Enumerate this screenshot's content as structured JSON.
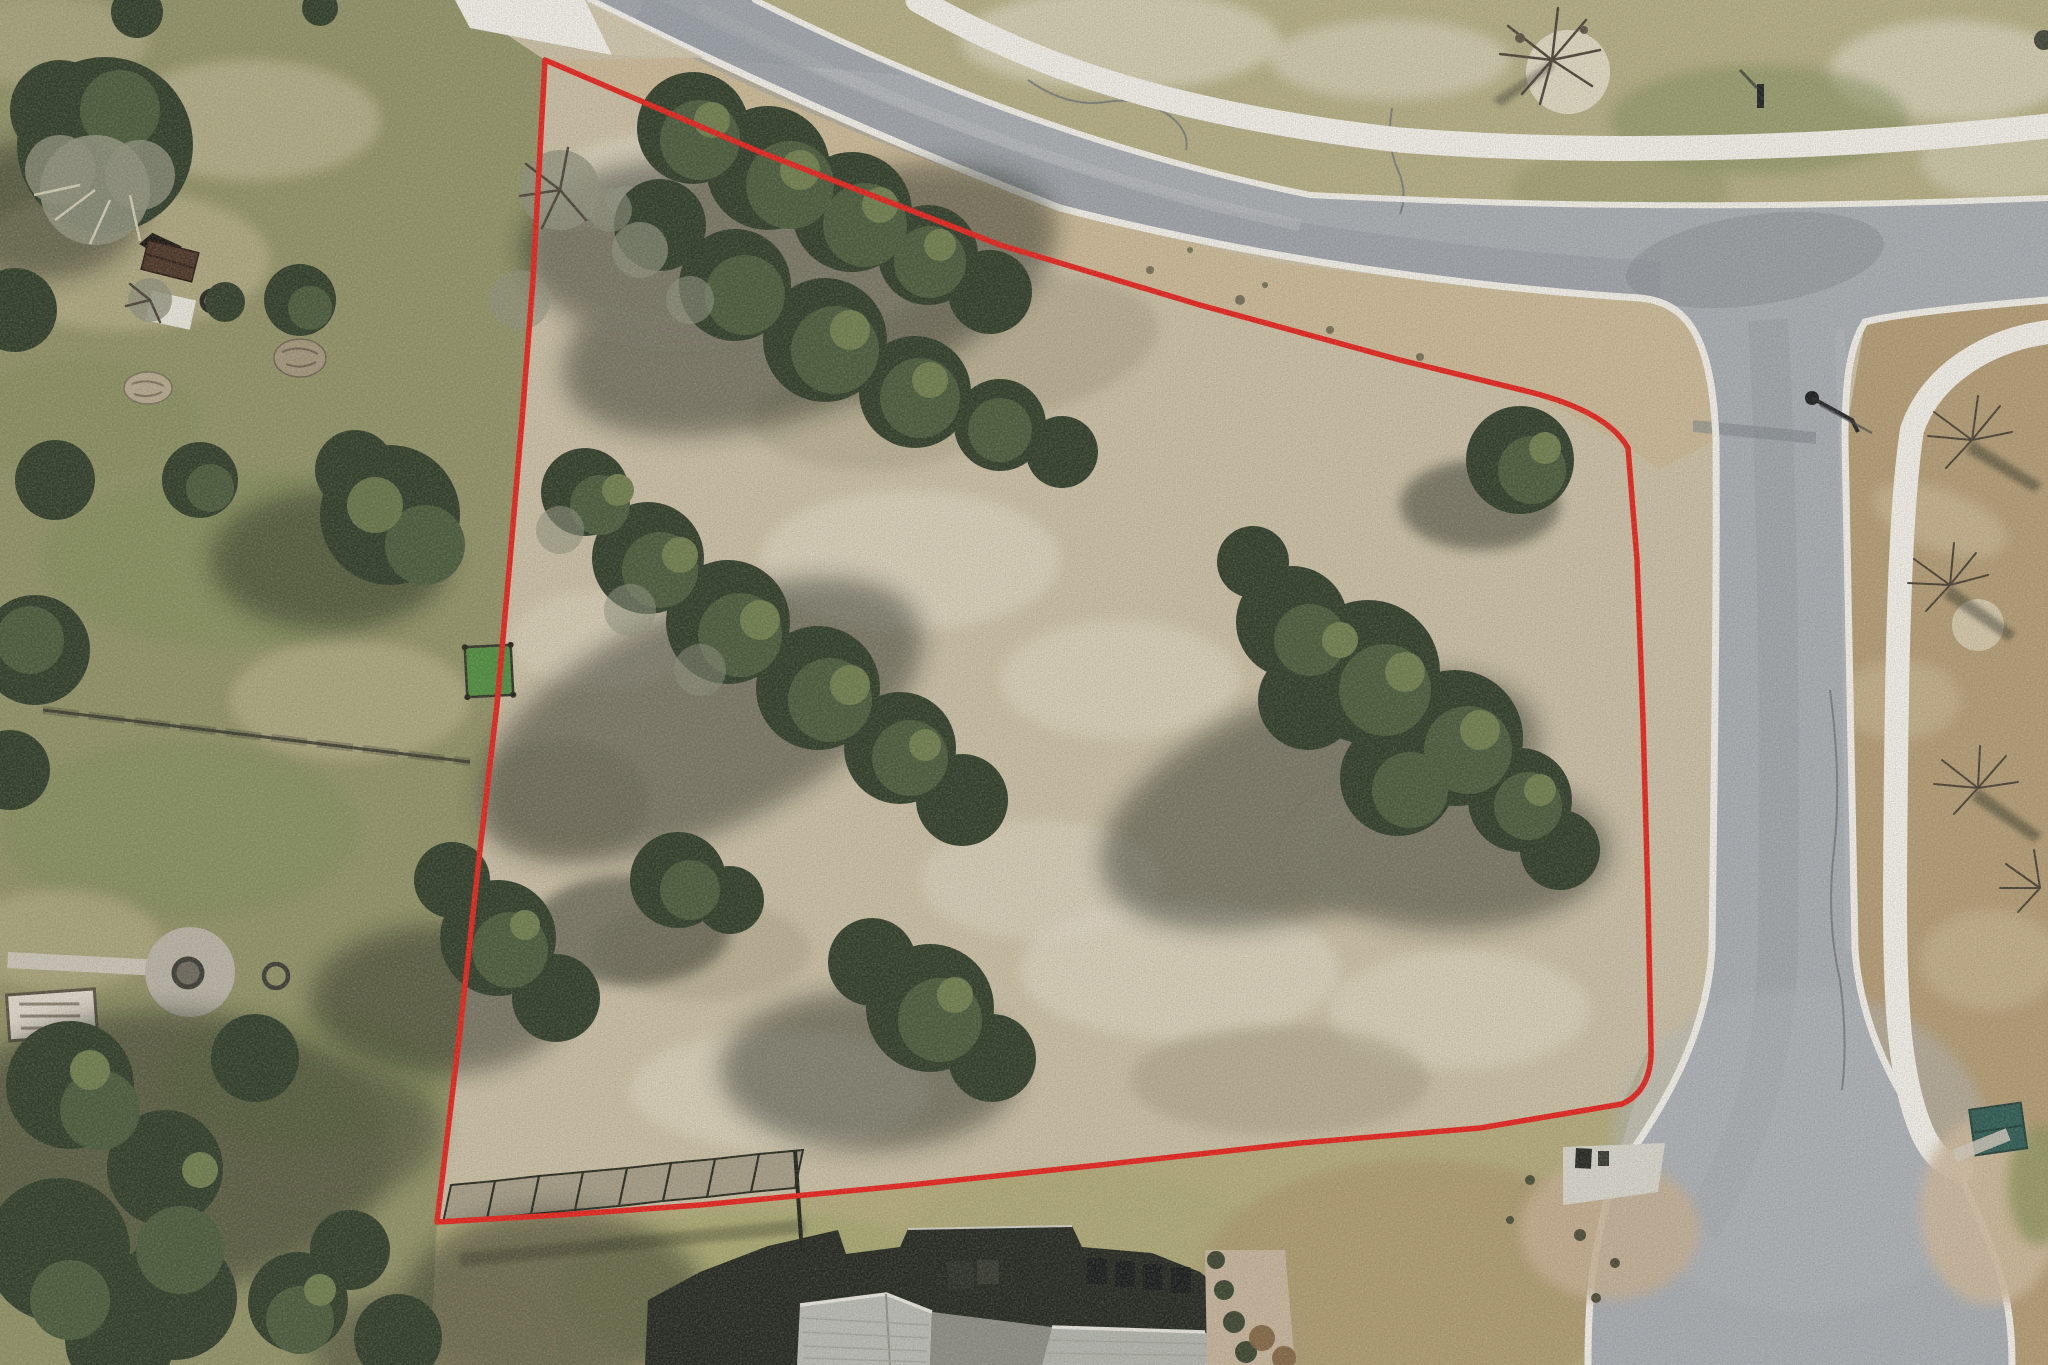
{
  "meta": {
    "type": "aerial-drone-photo",
    "description": "Overhead drone photo of a vacant wooded residential lot outlined with a red property-boundary line. A curved asphalt street with white concrete sidewalks runs along the top, a second street with a cul-de-sac bulb runs down the right side, a neighboring fenced yard with shed, fire pit and trees lies to the left, and the gray shingled roof of a house sits at bottom center. No text, UI chrome or labels are visible."
  },
  "colors": {
    "red": "#e3201a",
    "roadFill": "#a6abb1",
    "roadDark": "#8e949a",
    "roadLight": "#b7bcc0",
    "curb": "#efede6",
    "path": "#f0eee7",
    "lotGround": "#c8bda3",
    "lotPale": "#ddd6c2",
    "lotOlive": "#a29a7c",
    "gravelStrip": "#c9b795",
    "neighborGrass": "#8f9065",
    "neGrass": "#b2ab82",
    "nePale": "#d6cfb8",
    "eastField": "#b19a73",
    "bottomGrass": "#b2a97a",
    "treeDark": "#2e3c28",
    "treeMid": "#48593a",
    "treeLight": "#6d7c4c",
    "shadow": "#161d14",
    "houseShadow": "#22261f",
    "roofLight": "#b8b9b4",
    "roofMid": "#96978f",
    "shedBrown": "#4a3226",
    "tealShed": "#2c5a52",
    "turfGreen": "#4d8c3d",
    "fence": "#33342a"
  },
  "boundary": {
    "stroke_width": 5.5,
    "path": "M545,60 L760,152 L1000,245 L1200,305 L1400,360 L1530,392 Q1608,412 1628,448 L1637,560 L1643,720 L1648,900 L1651,1045 Q1653,1090 1622,1104 L1480,1128 L1300,1143 L1100,1165 L900,1186 L700,1205 L560,1215 L437,1222 L460,1030 L480,850 L497,705 L510,560 L522,420 L533,280 Z"
  },
  "regions": {
    "neighbor_west": "0,0 455,0 545,60 533,280 522,420 510,560 497,705 480,850 460,1030 437,1222 430,1365 0,1365",
    "south_strip": "437,1222 560,1215 700,1205 900,1186 1100,1165 1300,1143 1480,1128 1622,1104 1651,1045 1591,1250 1588,1365 430,1365",
    "northeast": "755,0 2048,0 2048,198 1800,212 1555,205 1310,195 1090,150 905,75",
    "east_field": "1865,322 2048,300 2048,1365 2012,1365 2000,1260 1962,1180 1905,1110 1862,1040 1855,950 1848,650 1845,440",
    "road_shoulder_wedge": "545,60 705,58 870,135 1060,208 1270,262 1480,288 1640,298 1690,303 1712,370 1716,440 1660,470 1628,448 1530,392 1400,360 1200,305 1000,245 760,152"
  },
  "roads": {
    "main_d": "M590,0 L755,0 C905,75 1090,150 1310,195 C1480,203 1700,212 2048,198 L2048,300 C1950,308 1890,315 1865,322 C1850,345 1845,380 1845,440 C1848,650 1852,850 1855,950 C1862,1040 1905,1110 1962,1180 C2000,1260 2012,1300 2012,1365 L1588,1365 C1588,1300 1591,1260 1612,1180 C1662,1110 1706,1040 1712,950 C1714,780 1717,600 1716,440 C1712,340 1690,303 1640,298 C1480,288 1270,262 1060,208 C870,135 705,58 590,0 Z",
    "curb_north_d": "M755,0 C905,75 1090,150 1310,195 C1480,203 1700,212 2048,198",
    "curb_southwest_d": "M590,0 C705,58 870,135 1060,208 C1270,262 1480,288 1640,298 C1690,303 1712,340 1716,440 C1717,600 1714,780 1712,950 C1706,1040 1662,1110 1612,1180 C1591,1260 1588,1300 1588,1365",
    "curb_east_d": "M2048,300 C1950,308 1890,315 1865,322 C1850,345 1845,380 1845,440 C1848,650 1852,850 1855,950 C1862,1040 1905,1110 1962,1180 C2000,1260 2012,1300 2012,1365",
    "streak_dark_top_d": "M640,10 C800,95 1000,180 1240,232 C1420,262 1560,275 1660,280",
    "streak_light_top_d": "M700,8 C860,90 1060,175 1300,225",
    "streak_dark_vert_d": "M1768,320 C1778,500 1780,700 1778,950 C1775,1060 1750,1140 1700,1230",
    "streak_light_vert_d": "M1840,330 C1846,500 1848,700 1850,950",
    "crack1_d": "M1028,80 q40,28 78,22 q36,-6 64,14 q20,16 16,34",
    "crack2_d": "M1392,108 q-6,36 6,62 q10,24 2,44",
    "crack3_d": "M1830,690 q12,90 4,160 q-8,70 6,130 q8,60 2,110"
  },
  "walkways": {
    "northwest_points": "455,0 585,0 612,55 470,28",
    "shoulder_wedge_points": "585,0 705,58 612,55",
    "north_d": "M918,0 C1040,70 1180,115 1400,140 C1600,156 1850,148 2048,126",
    "southeast_d": "M2048,332 C1990,340 1932,372 1912,430 C1898,520 1896,700 1895,900 C1895,1010 1900,1080 1922,1132 C1934,1158 1948,1166 1962,1170"
  },
  "fences": {
    "cross_points": "43,710 470,762",
    "west_points": "497,705 480,850 460,1030 438,1215",
    "south_shadow_points": "460,1260 805,1226"
  },
  "house": {
    "shadow_d": "M645,1365 L648,1300 L700,1272 L768,1246 L838,1230 L846,1254 L900,1247 L908,1229 L1072,1226 L1082,1247 L1152,1253 L1200,1272 L1237,1303 L1243,1365 Z",
    "roof_left_d": "M797,1365 L800,1305 L886,1294 L932,1312 L930,1365 Z",
    "roof_mid_d": "M930,1365 L932,1312 L1052,1327 L1042,1365 Z",
    "roof_right_d": "M1042,1365 L1052,1327 L1205,1332 L1237,1365 Z",
    "patio_d": "M1205,1250 L1285,1250 L1295,1365 L1207,1365 Z"
  },
  "objects": {
    "mailbox_pad_d": "M1563,1147 L1665,1143 L1658,1192 L1563,1205 Z"
  }
}
